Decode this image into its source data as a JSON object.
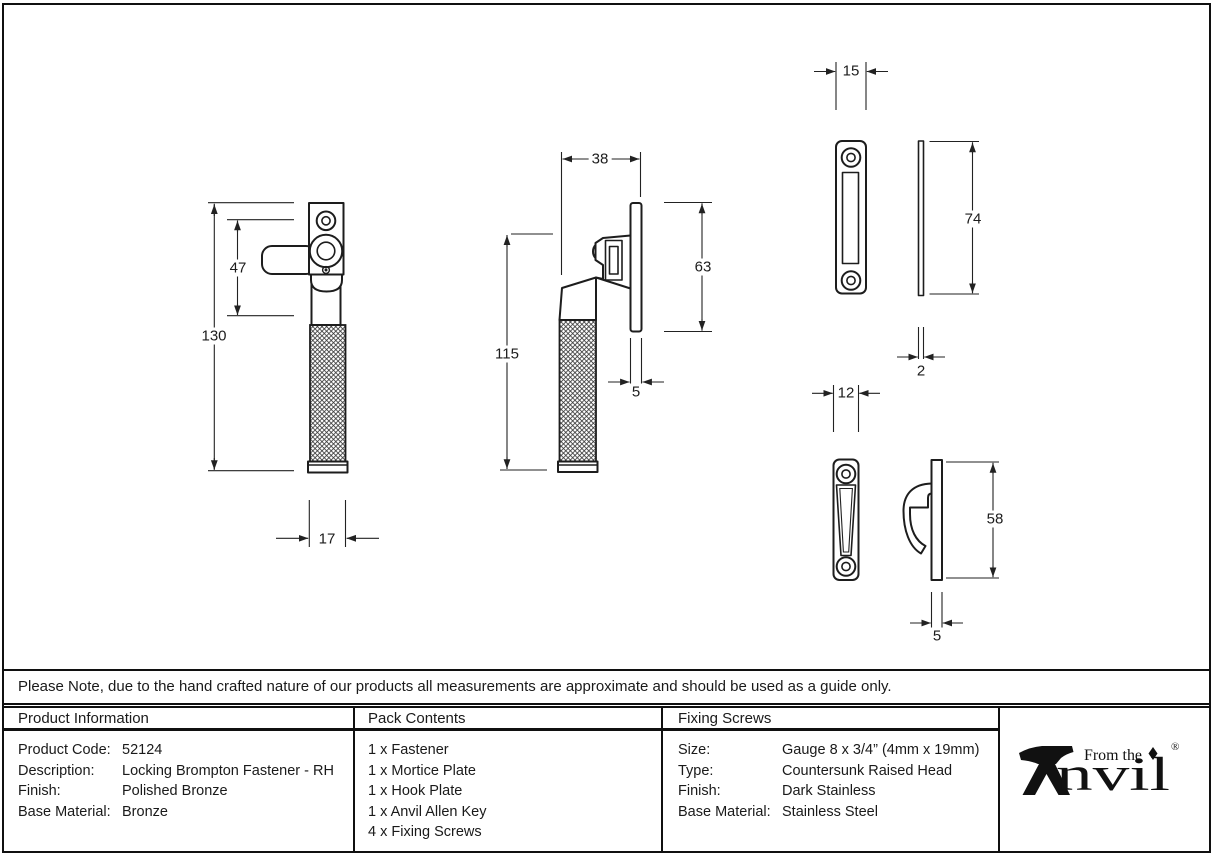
{
  "page": {
    "note": "Please Note, due to the hand crafted nature of our products all measurements are approximate and should be used as a guide only."
  },
  "dimensions": {
    "fastener_front": {
      "height": "130",
      "handle_offset": "47",
      "grip_width": "17"
    },
    "fastener_side": {
      "depth": "38",
      "height": "115",
      "plate_height": "63",
      "plate_thickness": "5"
    },
    "mortice_plate": {
      "width": "15",
      "height": "74",
      "thickness": "2"
    },
    "hook_plate": {
      "width": "12",
      "height": "58",
      "thickness": "5"
    }
  },
  "table": {
    "product_information": {
      "title": "Product Information",
      "rows": [
        {
          "label": "Product Code:",
          "value": "52124"
        },
        {
          "label": "Description:",
          "value": "Locking Brompton Fastener - RH"
        },
        {
          "label": "Finish:",
          "value": "Polished Bronze"
        },
        {
          "label": "Base Material:",
          "value": "Bronze"
        }
      ]
    },
    "pack_contents": {
      "title": "Pack Contents",
      "items": [
        "1 x Fastener",
        "1 x Mortice Plate",
        "1 x Hook Plate",
        "1 x Anvil Allen Key",
        "4 x Fixing Screws"
      ]
    },
    "fixing_screws": {
      "title": "Fixing Screws",
      "rows": [
        {
          "label": "Size:",
          "value": "Gauge 8 x 3/4” (4mm x 19mm)"
        },
        {
          "label": "Type:",
          "value": "Countersunk Raised Head"
        },
        {
          "label": "Finish:",
          "value": "Dark Stainless"
        },
        {
          "label": "Base Material:",
          "value": "Stainless Steel"
        }
      ]
    },
    "logo": {
      "tagline": "From the",
      "wordmark": "Anvil",
      "wordmark_suffix": "nvil",
      "registered": "®"
    }
  }
}
